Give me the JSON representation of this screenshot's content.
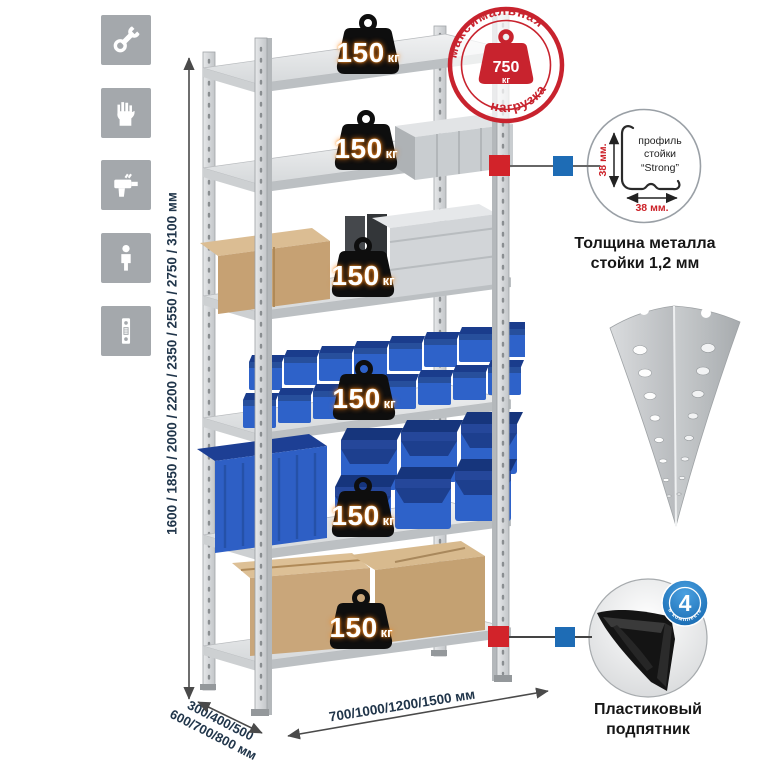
{
  "sidebar": {
    "icons": [
      {
        "name": "wrench-icon"
      },
      {
        "name": "gloves-icon"
      },
      {
        "name": "drill-icon"
      },
      {
        "name": "person-icon"
      },
      {
        "name": "upright-post-icon"
      }
    ]
  },
  "dimensions": {
    "height": "1600 / 1850 / 2000 / 2200 / 2350 / 2550 / 2750 / 3100 мм",
    "depth_line1": "300/400/500",
    "depth_line2": "600/700/800 мм",
    "width": "700/1000/1200/1500 мм",
    "text_color": "#20354a"
  },
  "rack": {
    "shelf_count": 6,
    "shelves": [
      {
        "load": "150",
        "unit": "кг"
      },
      {
        "load": "150",
        "unit": "кг"
      },
      {
        "load": "150",
        "unit": "кг"
      },
      {
        "load": "150",
        "unit": "кг"
      },
      {
        "load": "150",
        "unit": "кг"
      },
      {
        "load": "150",
        "unit": "кг"
      }
    ]
  },
  "stamp": {
    "arc_top": "максимальная",
    "arc_bottom": "нагрузка",
    "value": "750",
    "unit": "кг",
    "color": "#c8232e"
  },
  "profile_callout": {
    "line1": "профиль",
    "line2": "стойки",
    "line3": "“Strong”",
    "dim_v": "38 мм.",
    "dim_h": "38 мм.",
    "caption1": "Толщина металла",
    "caption2": "стойки 1,2 мм",
    "accent": "#cc2128",
    "marker_red": "#d2232a",
    "marker_blue": "#1e6cb5"
  },
  "foot_callout": {
    "badge_value": "4",
    "badge_label": "в комплекте",
    "caption1": "Пластиковый",
    "caption2": "подпятник",
    "badge_color": "#1777c4",
    "marker_red": "#d2232a",
    "marker_blue": "#1e6cb5"
  }
}
